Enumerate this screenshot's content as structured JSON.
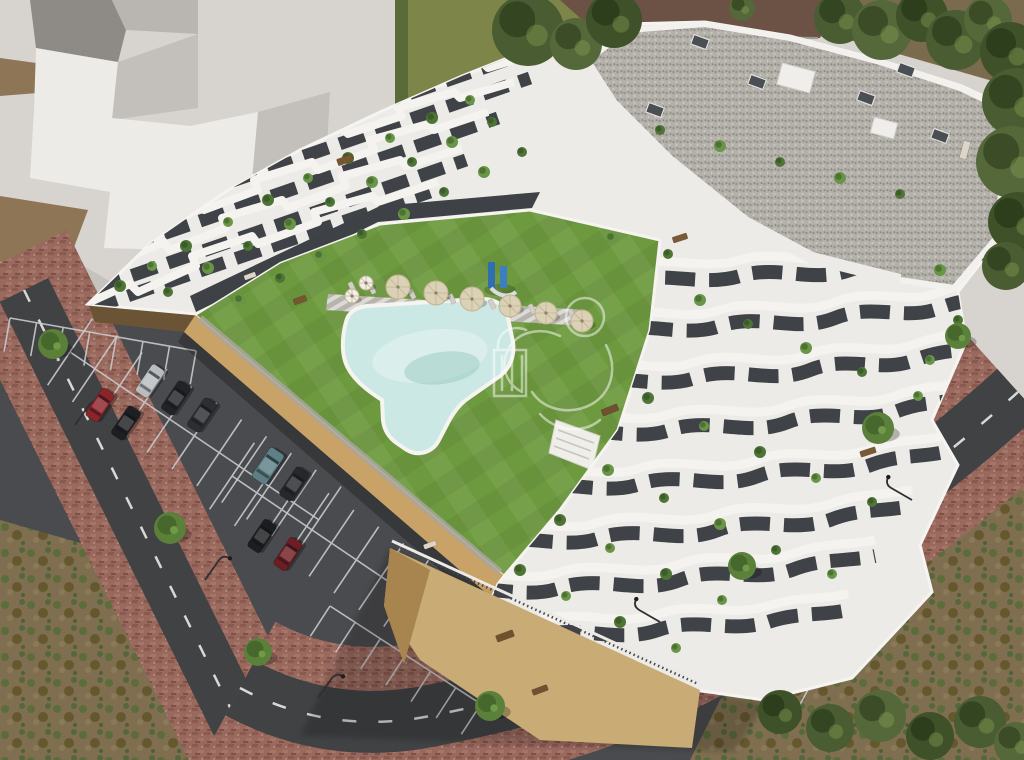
{
  "meta": {
    "title": "Aerial 3D architectural rendering of a modern white terraced apartment complex with communal lawn, free-form swimming pool, sun loungers, parasols, playground, parking lot with cars, and surrounding roads with brick sidewalks",
    "type": "architectural-visualization",
    "image_width": 1024,
    "image_height": 760
  },
  "watermark": {
    "name": "developer-logo-watermark",
    "style": "semi-transparent white outline emblem",
    "opacity": 0.5
  },
  "palette": {
    "plaza": "#d7d4d0",
    "massing_light": "#edebe8",
    "massing_shadow": "#c3bfbb",
    "dark_wall": "#8e8b87",
    "dirt": "#8d7556",
    "grass_top": "#7d8549",
    "tree_dark": "#49592f",
    "lawn": "#6e9a3f",
    "pool": "#cce8e4",
    "deck": "#b7b4ae",
    "asphalt_park": "#4a4b4e",
    "asphalt_road": "#404244",
    "brick": "#99695e",
    "wall_tan": "#c9a267",
    "podium_tan": "#c9ab76",
    "podium_shadow": "#a8854f",
    "building_white": "#ecebe7",
    "parapet_white": "#f3f2ef",
    "glazing": "#3f4246",
    "roof_gravel": "#b3b0a9",
    "scrub": "#7f6f50",
    "line_white": "#d8d8d7",
    "parasol_tan": "#dbd1b6",
    "lounger_gray": "#d2cfc9"
  },
  "scene": {
    "regions": [
      {
        "name": "neighbor-building-massing",
        "desc": "flat light-gray stepped massing model, top-left"
      },
      {
        "name": "top-grass-strip",
        "desc": "olive green grass with large tree, top center"
      },
      {
        "name": "apartment-building",
        "desc": "white stepped complex with wavy balcony bands and gravel roof"
      },
      {
        "name": "courtyard-lawn",
        "desc": "striped green lawn"
      },
      {
        "name": "swimming-pool",
        "desc": "free-form turquoise pool with white coping"
      },
      {
        "name": "parking-lot",
        "desc": "asphalt lot with white stalls and parked cars"
      },
      {
        "name": "access-roads",
        "desc": "two diagonal asphalt roads with dashed centerlines and brick sidewalks"
      },
      {
        "name": "scrubland",
        "desc": "mottled brown-green waste ground, bottom corners"
      }
    ],
    "counts": {
      "cars": 9,
      "parasols": 8,
      "street_trees": 7,
      "street_lamps": 5,
      "roof_chimneys": 6
    },
    "cars": [
      {
        "x": 150,
        "y": 381,
        "a": -56,
        "l": 33,
        "w": 15,
        "c": "#b9bcbe"
      },
      {
        "x": 176,
        "y": 398,
        "a": -56,
        "l": 34,
        "w": 15,
        "c": "#212326"
      },
      {
        "x": 202,
        "y": 415,
        "a": -56,
        "l": 34,
        "w": 15,
        "c": "#2c2e31"
      },
      {
        "x": 100,
        "y": 405,
        "a": -56,
        "l": 33,
        "w": 15,
        "c": "#8d2428"
      },
      {
        "x": 126,
        "y": 423,
        "a": -56,
        "l": 34,
        "w": 15,
        "c": "#1d1f22"
      },
      {
        "x": 268,
        "y": 466,
        "a": -56,
        "l": 36,
        "w": 17,
        "c": "#5d7f85"
      },
      {
        "x": 294,
        "y": 484,
        "a": -56,
        "l": 34,
        "w": 15,
        "c": "#26282b"
      },
      {
        "x": 262,
        "y": 536,
        "a": -56,
        "l": 33,
        "w": 15,
        "c": "#1b1d1f"
      },
      {
        "x": 288,
        "y": 554,
        "a": -56,
        "l": 33,
        "w": 15,
        "c": "#6e1e23"
      }
    ],
    "stall_rows": [
      {
        "x": 10,
        "y": 318,
        "a": 10,
        "n": 7,
        "p": 27,
        "len": 34,
        "d": false
      },
      {
        "x": 70,
        "y": 352,
        "a": 34,
        "n": 10,
        "p": 30,
        "len": 40,
        "d": true
      },
      {
        "x": 232,
        "y": 476,
        "a": 34,
        "n": 9,
        "p": 30,
        "len": 40,
        "d": true
      },
      {
        "x": 330,
        "y": 606,
        "a": 33,
        "n": 6,
        "p": 30,
        "len": 36,
        "d": false
      },
      {
        "x": 640,
        "y": 588,
        "a": 28,
        "n": 7,
        "p": 28,
        "len": 34,
        "d": false
      }
    ],
    "parasols": [
      {
        "x": 398,
        "y": 287,
        "r": 12,
        "tone": "tan"
      },
      {
        "x": 436,
        "y": 293,
        "r": 12,
        "tone": "tan"
      },
      {
        "x": 472,
        "y": 299,
        "r": 12,
        "tone": "tan"
      },
      {
        "x": 510,
        "y": 306,
        "r": 11,
        "tone": "tan"
      },
      {
        "x": 546,
        "y": 313,
        "r": 11,
        "tone": "tan"
      },
      {
        "x": 582,
        "y": 321,
        "r": 11,
        "tone": "tan"
      },
      {
        "x": 366,
        "y": 283,
        "r": 7,
        "tone": "white"
      },
      {
        "x": 352,
        "y": 296,
        "r": 7,
        "tone": "white"
      }
    ],
    "loungers": [
      {
        "x": 352,
        "y": 287
      },
      {
        "x": 372,
        "y": 289
      },
      {
        "x": 392,
        "y": 292
      },
      {
        "x": 412,
        "y": 294
      },
      {
        "x": 432,
        "y": 297
      },
      {
        "x": 452,
        "y": 299
      },
      {
        "x": 472,
        "y": 302
      },
      {
        "x": 492,
        "y": 304
      },
      {
        "x": 512,
        "y": 307
      },
      {
        "x": 532,
        "y": 309
      },
      {
        "x": 552,
        "y": 312
      },
      {
        "x": 572,
        "y": 314
      }
    ],
    "street_trees": [
      {
        "x": 53,
        "y": 344,
        "r": 15
      },
      {
        "x": 170,
        "y": 528,
        "r": 16
      },
      {
        "x": 258,
        "y": 652,
        "r": 14
      },
      {
        "x": 490,
        "y": 706,
        "r": 15
      },
      {
        "x": 878,
        "y": 428,
        "r": 16
      },
      {
        "x": 742,
        "y": 566,
        "r": 14
      },
      {
        "x": 958,
        "y": 336,
        "r": 13
      }
    ],
    "lamps": [
      {
        "x": 75,
        "y": 425,
        "rot": 35
      },
      {
        "x": 205,
        "y": 580,
        "rot": 35
      },
      {
        "x": 318,
        "y": 698,
        "rot": 35
      },
      {
        "x": 660,
        "y": 622,
        "rot": -60
      },
      {
        "x": 912,
        "y": 500,
        "rot": -60
      }
    ],
    "terrace_plants": [
      [
        120,
        286,
        6
      ],
      [
        152,
        266,
        5
      ],
      [
        186,
        246,
        6
      ],
      [
        228,
        222,
        5
      ],
      [
        268,
        200,
        6
      ],
      [
        308,
        178,
        5
      ],
      [
        348,
        158,
        6
      ],
      [
        390,
        138,
        5
      ],
      [
        432,
        118,
        6
      ],
      [
        470,
        100,
        5
      ],
      [
        168,
        292,
        5
      ],
      [
        208,
        268,
        6
      ],
      [
        248,
        246,
        5
      ],
      [
        290,
        224,
        6
      ],
      [
        330,
        202,
        5
      ],
      [
        372,
        182,
        6
      ],
      [
        412,
        162,
        5
      ],
      [
        452,
        142,
        6
      ],
      [
        492,
        122,
        5
      ],
      [
        240,
        300,
        6
      ],
      [
        280,
        278,
        5
      ],
      [
        320,
        256,
        6
      ],
      [
        362,
        234,
        5
      ],
      [
        404,
        214,
        6
      ],
      [
        444,
        192,
        5
      ],
      [
        484,
        172,
        6
      ],
      [
        522,
        152,
        5
      ],
      [
        612,
        238,
        6
      ],
      [
        668,
        254,
        5
      ],
      [
        700,
        300,
        6
      ],
      [
        748,
        324,
        5
      ],
      [
        806,
        348,
        6
      ],
      [
        862,
        372,
        5
      ],
      [
        918,
        396,
        5
      ],
      [
        648,
        398,
        6
      ],
      [
        704,
        426,
        5
      ],
      [
        760,
        452,
        6
      ],
      [
        816,
        478,
        5
      ],
      [
        872,
        502,
        5
      ],
      [
        608,
        470,
        6
      ],
      [
        664,
        498,
        5
      ],
      [
        720,
        524,
        6
      ],
      [
        776,
        550,
        5
      ],
      [
        832,
        574,
        5
      ],
      [
        560,
        520,
        6
      ],
      [
        610,
        548,
        5
      ],
      [
        666,
        574,
        6
      ],
      [
        722,
        600,
        5
      ],
      [
        520,
        570,
        6
      ],
      [
        566,
        596,
        5
      ],
      [
        620,
        622,
        6
      ],
      [
        676,
        648,
        5
      ],
      [
        660,
        130,
        5
      ],
      [
        720,
        146,
        6
      ],
      [
        780,
        162,
        5
      ],
      [
        840,
        178,
        6
      ],
      [
        900,
        194,
        5
      ],
      [
        940,
        270,
        6
      ],
      [
        958,
        320,
        5
      ],
      [
        930,
        360,
        5
      ]
    ],
    "furniture": [
      {
        "x": 345,
        "y": 160,
        "w": 16,
        "h": 7,
        "a": -20,
        "c": "#77572f"
      },
      {
        "x": 300,
        "y": 300,
        "w": 13,
        "h": 6,
        "a": -20,
        "c": "#77572f"
      },
      {
        "x": 610,
        "y": 410,
        "w": 17,
        "h": 7,
        "a": -22,
        "c": "#6f5130"
      },
      {
        "x": 505,
        "y": 636,
        "w": 18,
        "h": 7,
        "a": -20,
        "c": "#6f5130"
      },
      {
        "x": 868,
        "y": 452,
        "w": 16,
        "h": 6,
        "a": -18,
        "c": "#7a5a34"
      },
      {
        "x": 680,
        "y": 238,
        "w": 15,
        "h": 6,
        "a": -18,
        "c": "#7a5a34"
      },
      {
        "x": 965,
        "y": 150,
        "w": 18,
        "h": 7,
        "a": -75,
        "c": "#ddd6c6"
      },
      {
        "x": 250,
        "y": 276,
        "w": 12,
        "h": 5,
        "a": -20,
        "c": "#ddd6c6"
      },
      {
        "x": 540,
        "y": 690,
        "w": 16,
        "h": 6,
        "a": -20,
        "c": "#6f5130"
      },
      {
        "x": 430,
        "y": 545,
        "w": 13,
        "h": 5,
        "a": -20,
        "c": "#ddd6c6"
      }
    ],
    "chimneys": [
      {
        "x": 700,
        "y": 42
      },
      {
        "x": 757,
        "y": 82
      },
      {
        "x": 866,
        "y": 98
      },
      {
        "x": 940,
        "y": 136
      },
      {
        "x": 655,
        "y": 110
      },
      {
        "x": 906,
        "y": 70
      }
    ],
    "roof_boxes": [
      {
        "x": 796,
        "y": 78,
        "w": 34,
        "h": 22
      },
      {
        "x": 884,
        "y": 128,
        "w": 24,
        "h": 16
      }
    ],
    "canopy_trees": [
      [
        528,
        30,
        36
      ],
      [
        576,
        44,
        26
      ],
      [
        614,
        20,
        28
      ],
      [
        840,
        18,
        26
      ],
      [
        882,
        30,
        30
      ],
      [
        922,
        16,
        26
      ],
      [
        956,
        40,
        30
      ],
      [
        988,
        20,
        24
      ],
      [
        1010,
        52,
        30
      ],
      [
        1016,
        102,
        34
      ],
      [
        1012,
        162,
        36
      ],
      [
        1018,
        222,
        30
      ],
      [
        1006,
        266,
        24
      ],
      [
        742,
        8,
        13
      ],
      [
        780,
        712,
        22
      ],
      [
        830,
        728,
        24
      ],
      [
        880,
        716,
        26
      ],
      [
        930,
        736,
        24
      ],
      [
        980,
        722,
        26
      ],
      [
        1016,
        744,
        22
      ]
    ]
  }
}
